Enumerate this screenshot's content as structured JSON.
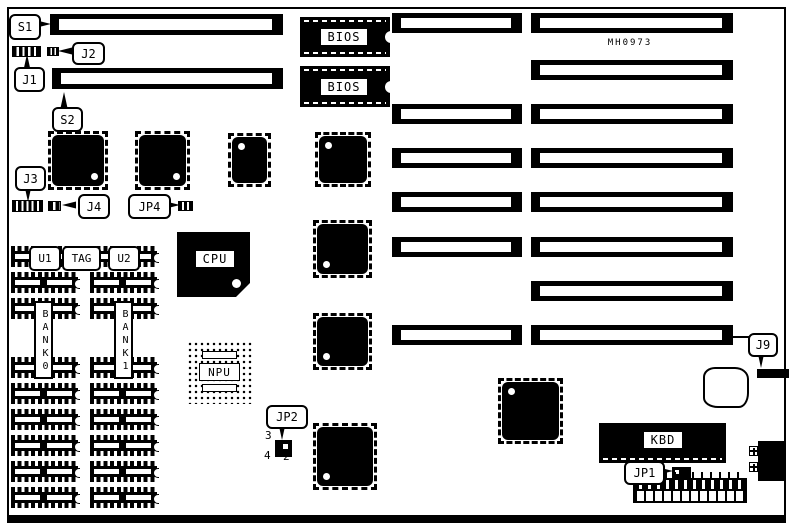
{
  "diagram": {
    "board_id": "MH0973",
    "callouts": {
      "s1": "S1",
      "j1": "J1",
      "j2": "J2",
      "s2": "S2",
      "j3": "J3",
      "j4": "J4",
      "jp4": "JP4",
      "jp2": "JP2",
      "jp1": "JP1",
      "j9": "J9"
    },
    "jp2_pin_numbers": {
      "pin3": "3",
      "pin4": "4",
      "pin2": "2"
    },
    "chip_labels": {
      "bios_top": "BIOS",
      "bios_bottom": "BIOS",
      "cpu": "CPU",
      "npu": "NPU",
      "kbd": "KBD"
    },
    "memory_labels": {
      "u1": "U1",
      "tag": "TAG",
      "u2": "U2",
      "bank0": "BANK0",
      "bank1": "BANK1"
    },
    "colors": {
      "ink": "#000000",
      "paper": "#ffffff"
    }
  }
}
